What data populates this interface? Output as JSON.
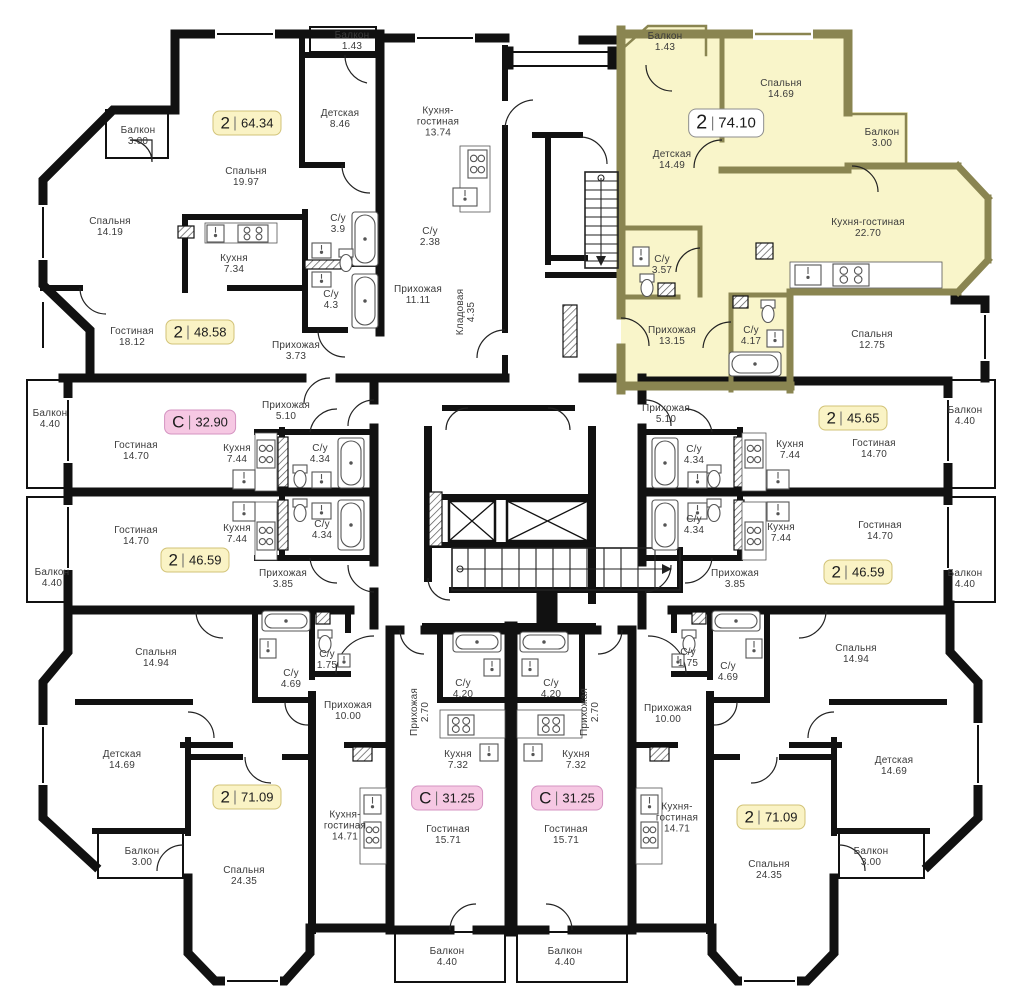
{
  "plan": {
    "name": "floor-plan",
    "colors": {
      "wall": "#111111",
      "highlight_wall": "#8a8551",
      "highlight_fill": "#f9f5ca",
      "badge_yellow_bg": "#faf3c5",
      "badge_yellow_border": "#d2c378",
      "badge_pink_bg": "#f6c8e3",
      "badge_pink_border": "#d493c1",
      "badge_white_bg": "#ffffff",
      "label_text": "#3b3b3b"
    },
    "room_labels": [
      {
        "name": "Балкон",
        "area": "3.00",
        "x": 138,
        "y": 136
      },
      {
        "name": "Спальня",
        "area": "14.19",
        "x": 110,
        "y": 227
      },
      {
        "name": "Спальня",
        "area": "19.97",
        "x": 246,
        "y": 177
      },
      {
        "name": "Детская",
        "area": "8.46",
        "x": 340,
        "y": 119
      },
      {
        "name": "Кухня",
        "area": "7.34",
        "x": 234,
        "y": 264
      },
      {
        "name": "С/у",
        "area": "3.9",
        "x": 338,
        "y": 224
      },
      {
        "name": "С/у",
        "area": "4.3",
        "x": 331,
        "y": 300
      },
      {
        "name": "Гостиная",
        "area": "18.12",
        "x": 132,
        "y": 337
      },
      {
        "name": "Прихожая",
        "area": "3.73",
        "x": 296,
        "y": 351
      },
      {
        "name": "Балкон",
        "area": "1.43",
        "x": 352,
        "y": 41
      },
      {
        "name": "Кухня-\nгостиная",
        "area": "13.74",
        "x": 438,
        "y": 122
      },
      {
        "name": "С/у",
        "area": "2.38",
        "x": 430,
        "y": 237
      },
      {
        "name": "Прихожая",
        "area": "11.11",
        "x": 418,
        "y": 295
      },
      {
        "name": "Кладовая",
        "area": "4.35",
        "x": 466,
        "y": 312,
        "rot": 1
      },
      {
        "name": "Балкон",
        "area": "1.43",
        "x": 665,
        "y": 42
      },
      {
        "name": "Спальня",
        "area": "14.69",
        "x": 781,
        "y": 89
      },
      {
        "name": "Балкон",
        "area": "3.00",
        "x": 882,
        "y": 138
      },
      {
        "name": "Детская",
        "area": "14.49",
        "x": 672,
        "y": 160
      },
      {
        "name": "Кухня-гостиная",
        "area": "22.70",
        "x": 868,
        "y": 228
      },
      {
        "name": "С/у",
        "area": "3.57",
        "x": 662,
        "y": 265
      },
      {
        "name": "Прихожая",
        "area": "13.15",
        "x": 672,
        "y": 336
      },
      {
        "name": "С/у",
        "area": "4.17",
        "x": 751,
        "y": 336
      },
      {
        "name": "Спальня",
        "area": "12.75",
        "x": 872,
        "y": 340
      },
      {
        "name": "Прихожая",
        "area": "5.10",
        "x": 666,
        "y": 414
      },
      {
        "name": "С/у",
        "area": "4.34",
        "x": 694,
        "y": 455
      },
      {
        "name": "Кухня",
        "area": "7.44",
        "x": 790,
        "y": 450
      },
      {
        "name": "Гостиная",
        "area": "14.70",
        "x": 874,
        "y": 449
      },
      {
        "name": "Балкон",
        "area": "4.40",
        "x": 965,
        "y": 416
      },
      {
        "name": "С/у",
        "area": "4.34",
        "x": 694,
        "y": 525
      },
      {
        "name": "Кухня",
        "area": "7.44",
        "x": 781,
        "y": 533
      },
      {
        "name": "Гостиная",
        "area": "14.70",
        "x": 880,
        "y": 531
      },
      {
        "name": "Прихожая",
        "area": "3.85",
        "x": 735,
        "y": 579
      },
      {
        "name": "Балкон",
        "area": "4.40",
        "x": 965,
        "y": 579
      },
      {
        "name": "Балкон",
        "area": "4.40",
        "x": 50,
        "y": 419
      },
      {
        "name": "Гостиная",
        "area": "14.70",
        "x": 136,
        "y": 451
      },
      {
        "name": "Кухня",
        "area": "7.44",
        "x": 237,
        "y": 454
      },
      {
        "name": "С/у",
        "area": "4.34",
        "x": 320,
        "y": 454
      },
      {
        "name": "Прихожая",
        "area": "5.10",
        "x": 286,
        "y": 411
      },
      {
        "name": "Гостиная",
        "area": "14.70",
        "x": 136,
        "y": 536
      },
      {
        "name": "Кухня",
        "area": "7.44",
        "x": 237,
        "y": 534
      },
      {
        "name": "С/у",
        "area": "4.34",
        "x": 322,
        "y": 530
      },
      {
        "name": "Прихожая",
        "area": "3.85",
        "x": 283,
        "y": 579
      },
      {
        "name": "Балкон",
        "area": "4.40",
        "x": 52,
        "y": 578
      },
      {
        "name": "Спальня",
        "area": "14.94",
        "x": 156,
        "y": 658
      },
      {
        "name": "С/у",
        "area": "4.69",
        "x": 291,
        "y": 679
      },
      {
        "name": "С/у",
        "area": "1.75",
        "x": 327,
        "y": 660
      },
      {
        "name": "Прихожая",
        "area": "10.00",
        "x": 348,
        "y": 711
      },
      {
        "name": "Детская",
        "area": "14.69",
        "x": 122,
        "y": 760
      },
      {
        "name": "Балкон",
        "area": "3.00",
        "x": 142,
        "y": 857
      },
      {
        "name": "Спальня",
        "area": "24.35",
        "x": 244,
        "y": 876
      },
      {
        "name": "Кухня-\nгостиная",
        "area": "14.71",
        "x": 345,
        "y": 826
      },
      {
        "name": "С/у",
        "area": "4.20",
        "x": 463,
        "y": 689
      },
      {
        "name": "Прихожая",
        "area": "2.70",
        "x": 420,
        "y": 712,
        "rot": 1
      },
      {
        "name": "Кухня",
        "area": "7.32",
        "x": 458,
        "y": 760
      },
      {
        "name": "Гостиная",
        "area": "15.71",
        "x": 448,
        "y": 835
      },
      {
        "name": "Балкон",
        "area": "4.40",
        "x": 447,
        "y": 957
      },
      {
        "name": "С/у",
        "area": "4.20",
        "x": 551,
        "y": 689
      },
      {
        "name": "Прихожая",
        "area": "2.70",
        "x": 590,
        "y": 712,
        "rot": 1
      },
      {
        "name": "Кухня",
        "area": "7.32",
        "x": 576,
        "y": 760
      },
      {
        "name": "Гостиная",
        "area": "15.71",
        "x": 566,
        "y": 835
      },
      {
        "name": "Балкон",
        "area": "4.40",
        "x": 565,
        "y": 957
      },
      {
        "name": "С/у",
        "area": "1.75",
        "x": 688,
        "y": 658
      },
      {
        "name": "С/у",
        "area": "4.69",
        "x": 728,
        "y": 672
      },
      {
        "name": "Прихожая",
        "area": "10.00",
        "x": 668,
        "y": 714
      },
      {
        "name": "Спальня",
        "area": "14.94",
        "x": 856,
        "y": 654
      },
      {
        "name": "Детская",
        "area": "14.69",
        "x": 894,
        "y": 766
      },
      {
        "name": "Кухня-\nгостиная",
        "area": "14.71",
        "x": 677,
        "y": 818
      },
      {
        "name": "Спальня",
        "area": "24.35",
        "x": 769,
        "y": 870
      },
      {
        "name": "Балкон",
        "area": "3.00",
        "x": 871,
        "y": 857
      }
    ],
    "badges": [
      {
        "rooms": "2",
        "area": "64.34",
        "x": 247,
        "y": 123,
        "style": "yellow"
      },
      {
        "rooms": "2",
        "area": "48.58",
        "x": 200,
        "y": 332,
        "style": "yellow"
      },
      {
        "rooms": "2",
        "area": "74.10",
        "x": 726,
        "y": 123,
        "style": "white"
      },
      {
        "rooms": "С",
        "area": "32.90",
        "x": 200,
        "y": 422,
        "style": "pink"
      },
      {
        "rooms": "2",
        "area": "45.65",
        "x": 853,
        "y": 418,
        "style": "yellow"
      },
      {
        "rooms": "2",
        "area": "46.59",
        "x": 195,
        "y": 560,
        "style": "yellow"
      },
      {
        "rooms": "2",
        "area": "46.59",
        "x": 858,
        "y": 572,
        "style": "yellow"
      },
      {
        "rooms": "2",
        "area": "71.09",
        "x": 247,
        "y": 797,
        "style": "yellow"
      },
      {
        "rooms": "С",
        "area": "31.25",
        "x": 447,
        "y": 798,
        "style": "pink"
      },
      {
        "rooms": "С",
        "area": "31.25",
        "x": 567,
        "y": 798,
        "style": "pink"
      },
      {
        "rooms": "2",
        "area": "71.09",
        "x": 771,
        "y": 817,
        "style": "yellow"
      }
    ]
  }
}
